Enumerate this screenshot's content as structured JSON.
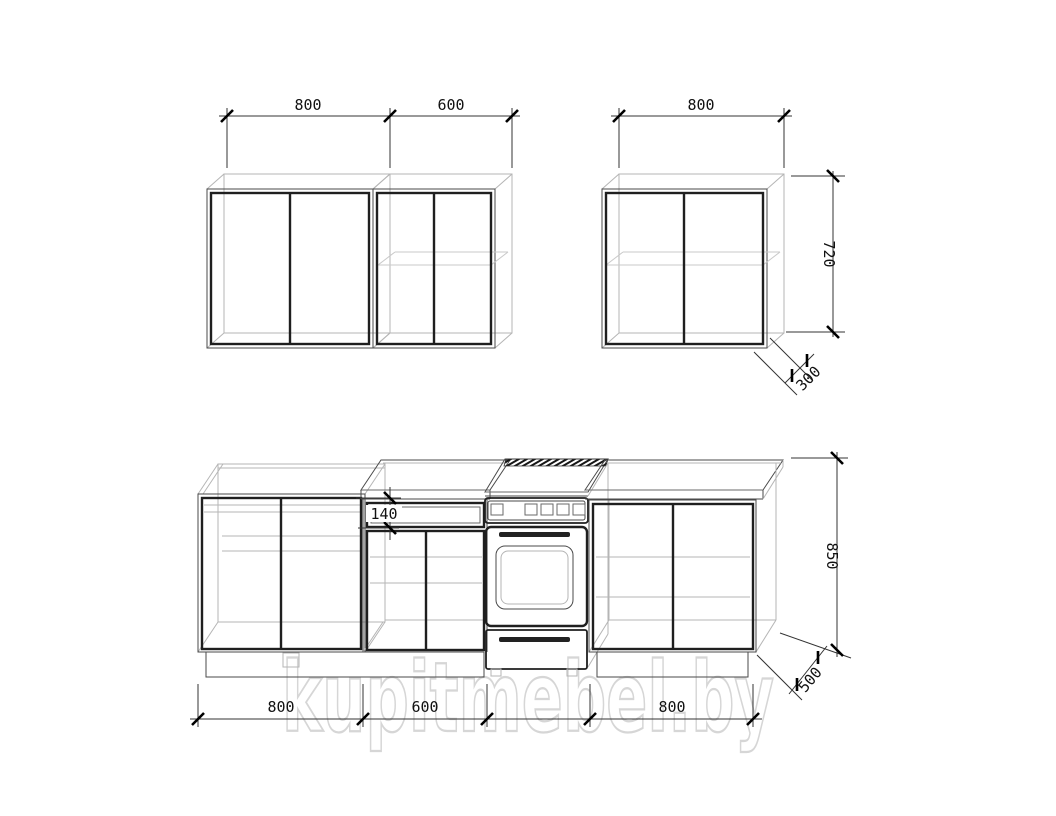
{
  "watermark": {
    "text": "kupitmebel.by"
  },
  "upper": {
    "cab1_width": "800",
    "cab2_width": "600",
    "cab3_width": "800",
    "height": "720",
    "depth": "300"
  },
  "lower": {
    "cab1_width": "800",
    "cab2_width": "600",
    "cab3_width": "800",
    "height": "850",
    "depth": "500",
    "drawer_height": "140"
  }
}
